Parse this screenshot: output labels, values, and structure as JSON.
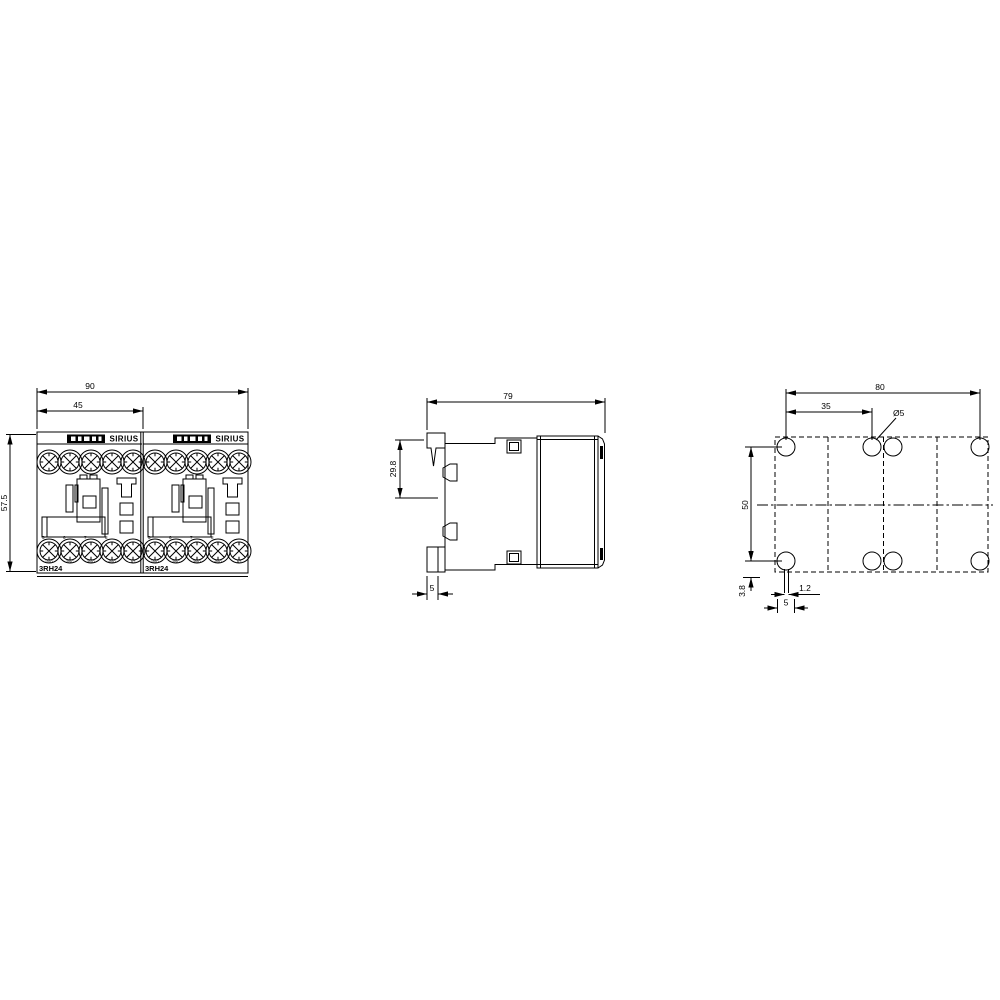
{
  "page": {
    "background": "#ffffff",
    "line_color": "#000000"
  },
  "front_view": {
    "dims": {
      "overall_width": "90",
      "module_width": "45",
      "overall_height": "57.5"
    },
    "modules": [
      {
        "brand": "SIRIUS",
        "model": "3RH24",
        "terminals": [
          "1NO",
          "2NC",
          "3NO",
          "4NO",
          "A2"
        ],
        "positions": [
          "5",
          "6",
          "7",
          "8"
        ]
      },
      {
        "brand": "SIRIUS",
        "model": "3RH24",
        "terminals": [
          "1NO",
          "2NC",
          "3NO",
          "4NO",
          "A2"
        ],
        "positions": [
          "5",
          "6",
          "7",
          "8"
        ]
      }
    ]
  },
  "side_view": {
    "dims": {
      "depth": "79",
      "rail_section_height": "29.8",
      "foot_width": "5"
    }
  },
  "drill_view": {
    "dims": {
      "hole_span_width": "80",
      "hole_pitch": "35",
      "hole_diameter": "Ø5",
      "hole_span_height": "50",
      "edge_offset": "3.8",
      "slot_width": "1.2",
      "slot_span": "5"
    }
  }
}
